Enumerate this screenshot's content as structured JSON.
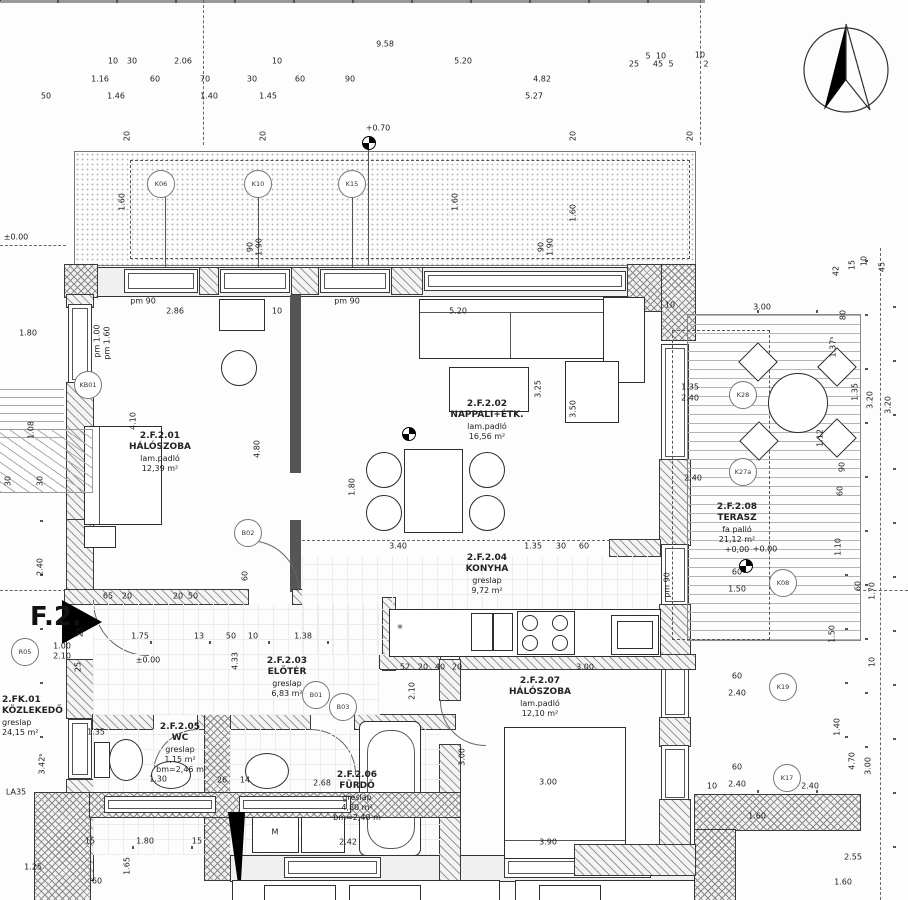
{
  "flat_marker": "F.2.",
  "rooms": [
    {
      "code": "2.F.2.01",
      "name": "HÁLÓSZOBA",
      "floor": "lam.padló",
      "area": "12,39 m²",
      "x": 160,
      "y": 431
    },
    {
      "code": "2.F.2.02",
      "name": "NAPPALI+ÉTK.",
      "floor": "lam.padló",
      "area": "16,56 m²",
      "x": 487,
      "y": 399
    },
    {
      "code": "2.F.2.03",
      "name": "ELŐTÉR",
      "floor": "greslap",
      "area": "6,83 m²",
      "x": 287,
      "y": 656
    },
    {
      "code": "2.F.2.04",
      "name": "KONYHA",
      "floor": "greslap",
      "area": "9,72 m²",
      "x": 487,
      "y": 553
    },
    {
      "code": "2.F.2.05",
      "name": "WC",
      "floor": "greslap",
      "area": "1,15 m²",
      "extra": "bm=2,46 m",
      "x": 180,
      "y": 722
    },
    {
      "code": "2.F.2.06",
      "name": "FÜRDŐ",
      "floor": "greslap",
      "area": "4,80 m²",
      "extra": "bm=2,40 m",
      "x": 357,
      "y": 770
    },
    {
      "code": "2.F.2.07",
      "name": "HÁLÓSZOBA",
      "floor": "lam.padló",
      "area": "12,10 m²",
      "x": 540,
      "y": 676
    },
    {
      "code": "2.F.2.08",
      "name": "TERASZ",
      "floor": "fa palló",
      "area": "21,12 m²",
      "extra": "+0,00",
      "x": 737,
      "y": 502
    },
    {
      "code": "2.FK.01",
      "name": "KÖZLEKEDŐ",
      "floor": "greslap",
      "area": "24,15 m²",
      "x": 2,
      "y": 695,
      "a": "l"
    }
  ],
  "tags": [
    {
      "id": "K06",
      "x": 161,
      "y": 184
    },
    {
      "id": "K10",
      "x": 258,
      "y": 184
    },
    {
      "id": "K15",
      "x": 352,
      "y": 184
    },
    {
      "id": "KB01",
      "x": 88,
      "y": 385
    },
    {
      "id": "R05",
      "x": 25,
      "y": 652
    },
    {
      "id": "B01",
      "x": 316,
      "y": 695
    },
    {
      "id": "B02",
      "x": 248,
      "y": 533
    },
    {
      "id": "B03",
      "x": 343,
      "y": 707
    },
    {
      "id": "K28",
      "x": 743,
      "y": 395
    },
    {
      "id": "K27a",
      "x": 743,
      "y": 472
    },
    {
      "id": "K08",
      "x": 783,
      "y": 583
    },
    {
      "id": "K19",
      "x": 783,
      "y": 687
    },
    {
      "id": "K17",
      "x": 787,
      "y": 778
    }
  ],
  "labels": [
    {
      "t": "9.58",
      "x": 385,
      "y": 44
    },
    {
      "t": "10",
      "x": 113,
      "y": 61
    },
    {
      "t": "30",
      "x": 132,
      "y": 61
    },
    {
      "t": "2.06",
      "x": 183,
      "y": 61
    },
    {
      "t": "10",
      "x": 277,
      "y": 61
    },
    {
      "t": "5.20",
      "x": 463,
      "y": 61
    },
    {
      "t": "5",
      "x": 648,
      "y": 56
    },
    {
      "t": "10",
      "x": 661,
      "y": 56
    },
    {
      "t": "25",
      "x": 634,
      "y": 64
    },
    {
      "t": "45",
      "x": 658,
      "y": 64
    },
    {
      "t": "5",
      "x": 671,
      "y": 64
    },
    {
      "t": "10",
      "x": 700,
      "y": 55
    },
    {
      "t": "2",
      "x": 706,
      "y": 64
    },
    {
      "t": "1.16",
      "x": 100,
      "y": 79
    },
    {
      "t": "60",
      "x": 155,
      "y": 79
    },
    {
      "t": "70",
      "x": 205,
      "y": 79
    },
    {
      "t": "30",
      "x": 252,
      "y": 79
    },
    {
      "t": "60",
      "x": 300,
      "y": 79
    },
    {
      "t": "90",
      "x": 350,
      "y": 79
    },
    {
      "t": "4.82",
      "x": 542,
      "y": 79
    },
    {
      "t": "50",
      "x": 46,
      "y": 96
    },
    {
      "t": "1.46",
      "x": 116,
      "y": 96
    },
    {
      "t": "1.40",
      "x": 209,
      "y": 96
    },
    {
      "t": "1.45",
      "x": 268,
      "y": 96
    },
    {
      "t": "5.27",
      "x": 534,
      "y": 96
    },
    {
      "t": "+0.70",
      "x": 378,
      "y": 128
    },
    {
      "t": "20",
      "x": 127,
      "y": 136,
      "r": 1
    },
    {
      "t": "20",
      "x": 263,
      "y": 136,
      "r": 1
    },
    {
      "t": "20",
      "x": 573,
      "y": 136,
      "r": 1
    },
    {
      "t": "20",
      "x": 690,
      "y": 136,
      "r": 1
    },
    {
      "t": "1.60",
      "x": 122,
      "y": 202,
      "r": 1
    },
    {
      "t": "1.60",
      "x": 455,
      "y": 202,
      "r": 1
    },
    {
      "t": "1.60",
      "x": 573,
      "y": 213,
      "r": 1
    },
    {
      "t": "90",
      "x": 250,
      "y": 247,
      "r": 1
    },
    {
      "t": "1.90",
      "x": 259,
      "y": 247,
      "r": 1
    },
    {
      "t": "90",
      "x": 541,
      "y": 247,
      "r": 1
    },
    {
      "t": "1.90",
      "x": 550,
      "y": 247,
      "r": 1
    },
    {
      "t": "pm 90",
      "x": 143,
      "y": 301
    },
    {
      "t": "2.86",
      "x": 175,
      "y": 311
    },
    {
      "t": "10",
      "x": 277,
      "y": 311
    },
    {
      "t": "pm 90",
      "x": 347,
      "y": 301
    },
    {
      "t": "5.20",
      "x": 458,
      "y": 311
    },
    {
      "t": "10",
      "x": 670,
      "y": 305
    },
    {
      "t": "3.00",
      "x": 762,
      "y": 307
    },
    {
      "t": "pm 1.60",
      "x": 107,
      "y": 343,
      "r": 1
    },
    {
      "t": "1.80",
      "x": 28,
      "y": 333
    },
    {
      "t": "pm 1.00",
      "x": 97,
      "y": 341,
      "r": 1
    },
    {
      "t": "1.08",
      "x": 31,
      "y": 430,
      "r": 1
    },
    {
      "t": "30",
      "x": 8,
      "y": 481,
      "r": 1
    },
    {
      "t": "30",
      "x": 40,
      "y": 481,
      "r": 1
    },
    {
      "t": "4.10",
      "x": 133,
      "y": 421,
      "r": 1
    },
    {
      "t": "4.80",
      "x": 257,
      "y": 449,
      "r": 1
    },
    {
      "t": "2.40",
      "x": 40,
      "y": 567,
      "r": 1
    },
    {
      "t": "3.25",
      "x": 538,
      "y": 389,
      "r": 1
    },
    {
      "t": "3.50",
      "x": 573,
      "y": 409,
      "r": 1
    },
    {
      "t": "1.80",
      "x": 352,
      "y": 487,
      "r": 1
    },
    {
      "t": "3.40",
      "x": 398,
      "y": 546
    },
    {
      "t": "1.35",
      "x": 533,
      "y": 546
    },
    {
      "t": "30",
      "x": 561,
      "y": 546
    },
    {
      "t": "60",
      "x": 584,
      "y": 546
    },
    {
      "t": "65",
      "x": 108,
      "y": 596
    },
    {
      "t": "20",
      "x": 127,
      "y": 596
    },
    {
      "t": "20",
      "x": 178,
      "y": 596
    },
    {
      "t": "50",
      "x": 193,
      "y": 596
    },
    {
      "t": "±0.00",
      "x": 148,
      "y": 660
    },
    {
      "t": "1.75",
      "x": 140,
      "y": 636
    },
    {
      "t": "13",
      "x": 199,
      "y": 636
    },
    {
      "t": "50",
      "x": 231,
      "y": 636
    },
    {
      "t": "10",
      "x": 253,
      "y": 636
    },
    {
      "t": "1.38",
      "x": 303,
      "y": 636
    },
    {
      "t": "4.33",
      "x": 235,
      "y": 661,
      "r": 1
    },
    {
      "t": "52",
      "x": 405,
      "y": 667
    },
    {
      "t": "20",
      "x": 423,
      "y": 667
    },
    {
      "t": "40",
      "x": 440,
      "y": 667
    },
    {
      "t": "20",
      "x": 457,
      "y": 667
    },
    {
      "t": "3.00",
      "x": 585,
      "y": 667
    },
    {
      "t": "2.10",
      "x": 412,
      "y": 691,
      "r": 1
    },
    {
      "t": "60",
      "x": 245,
      "y": 576,
      "r": 1
    },
    {
      "t": "1.00",
      "x": 62,
      "y": 646
    },
    {
      "t": "2.10",
      "x": 62,
      "y": 656
    },
    {
      "t": "25",
      "x": 80,
      "y": 632,
      "r": 1
    },
    {
      "t": "25",
      "x": 78,
      "y": 667,
      "r": 1
    },
    {
      "t": "1.35",
      "x": 96,
      "y": 732
    },
    {
      "t": "1.30",
      "x": 158,
      "y": 779
    },
    {
      "t": "26",
      "x": 222,
      "y": 780
    },
    {
      "t": "14",
      "x": 245,
      "y": 780
    },
    {
      "t": "2.68",
      "x": 322,
      "y": 783
    },
    {
      "t": "2.42",
      "x": 348,
      "y": 842
    },
    {
      "t": "3.00",
      "x": 462,
      "y": 757,
      "r": 1
    },
    {
      "t": "3.00",
      "x": 548,
      "y": 782
    },
    {
      "t": "3.90",
      "x": 548,
      "y": 842
    },
    {
      "t": "15",
      "x": 90,
      "y": 841
    },
    {
      "t": "1.80",
      "x": 145,
      "y": 841
    },
    {
      "t": "15",
      "x": 197,
      "y": 841
    },
    {
      "t": "1.65",
      "x": 127,
      "y": 866,
      "r": 1
    },
    {
      "t": "1.25",
      "x": 33,
      "y": 867
    },
    {
      "t": "60",
      "x": 97,
      "y": 881
    },
    {
      "t": "LA35",
      "x": 16,
      "y": 792
    },
    {
      "t": "3.42⁵",
      "x": 42,
      "y": 764,
      "r": 1
    },
    {
      "t": "M",
      "x": 275,
      "y": 832
    },
    {
      "t": "✳",
      "x": 400,
      "y": 627
    },
    {
      "t": "1.35",
      "x": 690,
      "y": 387
    },
    {
      "t": "2.40",
      "x": 690,
      "y": 398
    },
    {
      "t": "2.40",
      "x": 693,
      "y": 478
    },
    {
      "t": "1.37⁵",
      "x": 833,
      "y": 347,
      "r": 1
    },
    {
      "t": "1.35",
      "x": 855,
      "y": 392,
      "r": 1
    },
    {
      "t": "3.20",
      "x": 870,
      "y": 400,
      "r": 1
    },
    {
      "t": "3.20",
      "x": 888,
      "y": 405,
      "r": 1
    },
    {
      "t": "1.12",
      "x": 820,
      "y": 438,
      "r": 1
    },
    {
      "t": "90",
      "x": 842,
      "y": 467,
      "r": 1
    },
    {
      "t": "60",
      "x": 840,
      "y": 491,
      "r": 1
    },
    {
      "t": "80",
      "x": 843,
      "y": 315,
      "r": 1
    },
    {
      "t": "1.10",
      "x": 838,
      "y": 547,
      "r": 1
    },
    {
      "t": "60",
      "x": 858,
      "y": 586,
      "r": 1
    },
    {
      "t": "1.70",
      "x": 872,
      "y": 591,
      "r": 1
    },
    {
      "t": "1.50",
      "x": 832,
      "y": 634,
      "r": 1
    },
    {
      "t": "10",
      "x": 872,
      "y": 662,
      "r": 1
    },
    {
      "t": "1.40",
      "x": 837,
      "y": 727,
      "r": 1
    },
    {
      "t": "4.70",
      "x": 852,
      "y": 761,
      "r": 1
    },
    {
      "t": "3.00",
      "x": 868,
      "y": 766,
      "r": 1
    },
    {
      "t": "60",
      "x": 737,
      "y": 572
    },
    {
      "t": "1.50",
      "x": 737,
      "y": 589
    },
    {
      "t": "60",
      "x": 737,
      "y": 676
    },
    {
      "t": "2.40",
      "x": 737,
      "y": 693
    },
    {
      "t": "60",
      "x": 737,
      "y": 767
    },
    {
      "t": "2.40",
      "x": 737,
      "y": 784
    },
    {
      "t": "2.40",
      "x": 810,
      "y": 786
    },
    {
      "t": "10",
      "x": 712,
      "y": 786
    },
    {
      "t": "+0.00",
      "x": 765,
      "y": 549
    },
    {
      "t": "pm 90",
      "x": 667,
      "y": 585,
      "r": 1
    },
    {
      "t": "42",
      "x": 836,
      "y": 271,
      "r": 1
    },
    {
      "t": "15",
      "x": 852,
      "y": 265,
      "r": 1
    },
    {
      "t": "10",
      "x": 864,
      "y": 261,
      "r": 1
    },
    {
      "t": "45",
      "x": 882,
      "y": 267,
      "r": 1
    },
    {
      "t": "1.60",
      "x": 757,
      "y": 816
    },
    {
      "t": "2.55",
      "x": 853,
      "y": 857
    },
    {
      "t": "1.60",
      "x": 843,
      "y": 882
    },
    {
      "t": "±0.00",
      "x": 16,
      "y": 237
    }
  ]
}
